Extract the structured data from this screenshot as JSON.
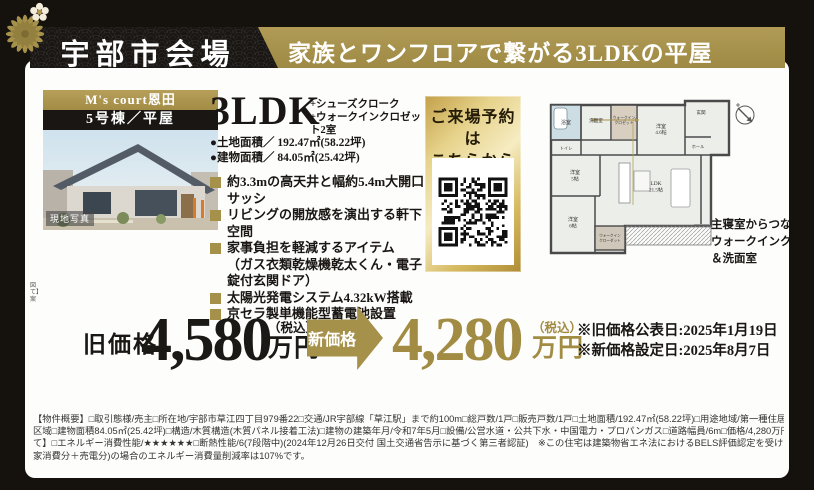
{
  "header": {
    "venue": "宇部市会場",
    "catch": "家族とワンフロアで繋がる3LDKの平屋"
  },
  "photo": {
    "brand": "M's court恩田",
    "unit": "5号棟／平屋",
    "caption": "現地写真"
  },
  "spec": {
    "layout": "3LDK",
    "layout_plus_1": "+シューズクローク",
    "layout_plus_2": "+ウォークインクロゼット2室",
    "land": "●土地面積／ 192.47㎡(58.22坪)",
    "building": "●建物面積／ 84.05㎡(25.42坪)"
  },
  "features": [
    {
      "text": "約3.3mの高天井と幅約5.4m大開口サッシ"
    },
    {
      "text": "リビングの開放感を演出する軒下空間"
    },
    {
      "text": "家事負担を軽減するアイテム"
    },
    {
      "text": "（ガス衣類乾燥機乾太くん・電子錠付玄関ドア）"
    },
    {
      "text": "太陽光発電システム4.32kW搭載"
    },
    {
      "text": "京セラ製単機能型蓄電池設置"
    }
  ],
  "reserve": {
    "line1": "ご来場予約は",
    "line2": "こちらから"
  },
  "floor_plan": {
    "rooms": {
      "bath": "浴室",
      "wash": "洗面室",
      "wic1a": "ウォークイン",
      "wic1b": "クロゼット",
      "r46a": "洋室",
      "r46b": "4.6帖",
      "entrance": "玄関",
      "hall": "ホール",
      "toilet": "トイレ",
      "r5a": "洋室",
      "r5b": "5帖",
      "ldka": "LDK",
      "ldkb": "21.5帖",
      "r6a": "洋室",
      "r6b": "6帖",
      "wic2a": "ウォークイン",
      "wic2b": "クローゼット"
    },
    "annotation": {
      "line1": "主寝室からつながる",
      "line2": "ウォークインクロゼット",
      "line3": "＆洗面室"
    }
  },
  "price": {
    "old_label": "旧価格",
    "old_value": "4,580",
    "new_label": "新価格",
    "new_value": "4,280",
    "tax": "（税込）",
    "unit": "万円",
    "note_old": "※旧価格公表日:2025年1月19日",
    "note_new": "※新価格設定日:2025年8月7日",
    "frag1": "図",
    "frag2": "て】",
    "frag3": "案"
  },
  "legal": {
    "line1": "【物件概要】□取引態様/売主□所在地/宇部市草江四丁目979番22□交通/JR宇部線「草江駅」まで約100m□総戸数/1戸□販売戸数/1戸□土地面積/192.47㎡(58.22坪)□用途地域/第一種住居地域□都市計画/非線引き",
    "line2": "区域□建物面積84.05㎡(25.42坪)□構造/木質構造(木質パネル接着工法)□建物の建築年月/令和7年5月□設備/公営水道・公共下水・中国電力・プロパンガス□道路幅員/6m□価格/4,280万円(税込)　【省エネ性能につい",
    "line3": "て】□エネルギー消費性能/★★★★★★□断熱性能/6(7段階中)(2024年12月26日交付 国土交通省告示に基づく第三者認証)　※この住宅は建築物省エネ法におけるBELS評価認定を受けています。※この住宅の再エネあり(自",
    "line4": "家消費分＋売電分)の場合のエネルギー消費量削減率は107%です。"
  },
  "colors": {
    "gold": "#a6914b",
    "price_gold": "#a28c44",
    "ink": "#191613"
  }
}
